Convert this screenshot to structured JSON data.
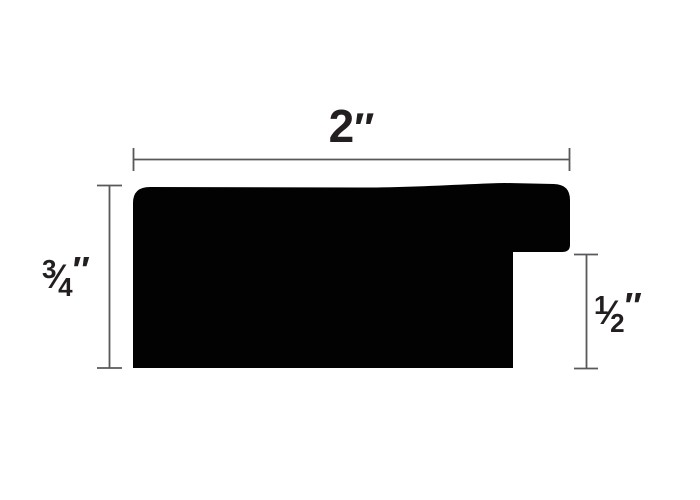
{
  "figure": {
    "background_color": "#ffffff",
    "profile_fill": "#020202",
    "dimension_line_color": "#58595b",
    "label_color": "#231f20"
  },
  "labels": {
    "width": {
      "value": "2",
      "unit": "″"
    },
    "height": {
      "num": "3",
      "slash": "⁄",
      "den": "4",
      "unit": "″"
    },
    "rabbet": {
      "num": "1",
      "slash": "⁄",
      "den": "2",
      "unit": "″"
    }
  }
}
